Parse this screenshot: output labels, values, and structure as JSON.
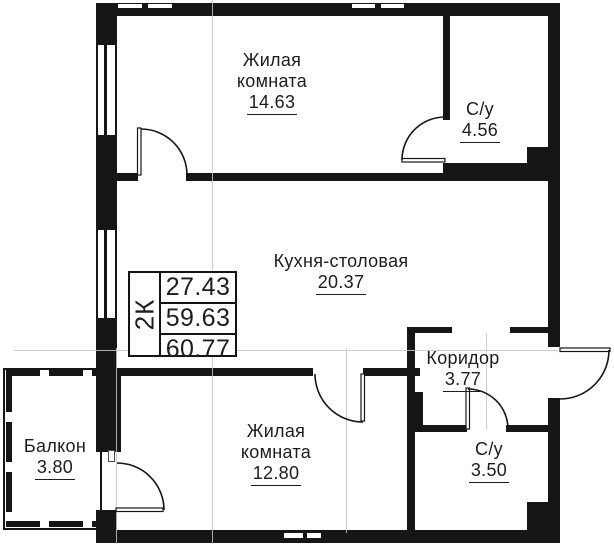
{
  "plan": {
    "info_box": {
      "unit": "2К",
      "values": [
        "27.43",
        "59.63",
        "60.77"
      ]
    },
    "rooms": [
      {
        "id": "living-top",
        "lines": [
          "Жилая",
          "комната"
        ],
        "area": "14.63"
      },
      {
        "id": "bath-top",
        "lines": [
          "С/у"
        ],
        "area": "4.56"
      },
      {
        "id": "kitchen",
        "lines": [
          "Кухня-столовая"
        ],
        "area": "20.37"
      },
      {
        "id": "corridor",
        "lines": [
          "Коридор"
        ],
        "area": "3.77"
      },
      {
        "id": "living-bottom",
        "lines": [
          "Жилая",
          "комната"
        ],
        "area": "12.80"
      },
      {
        "id": "bath-bottom",
        "lines": [
          "С/у"
        ],
        "area": "3.50"
      },
      {
        "id": "balcony",
        "lines": [
          "Балкон"
        ],
        "area": "3.80"
      }
    ],
    "colors": {
      "wall": "#161616",
      "grid_line": "#c6c6c6",
      "text": "#1d1d1d",
      "background": "#ffffff"
    }
  }
}
